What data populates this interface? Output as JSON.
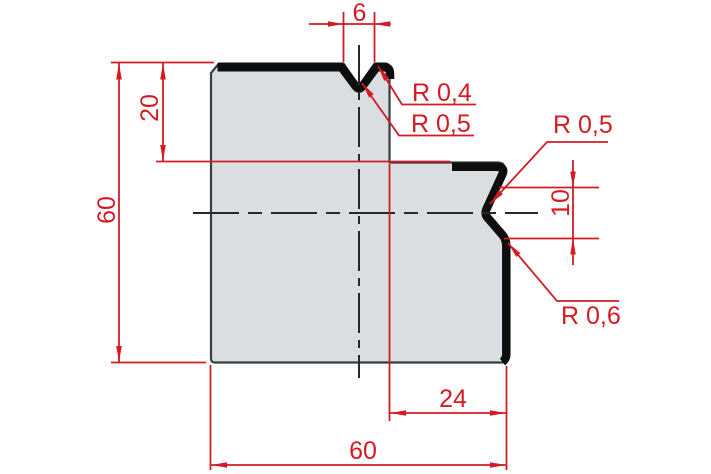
{
  "drawing": {
    "type": "technical-cross-section",
    "part_name": "press-brake-die-profile",
    "colors": {
      "dimension_red": "#d31b24",
      "part_fill": "#dbdee1",
      "outline_gray": "#3a3e42",
      "working_edge_black": "#0e0e0e",
      "centerline_dark": "#26282b",
      "background": "#ffffff"
    },
    "dimensions": {
      "top_notch_width": "6",
      "step_depth": "20",
      "overall_height": "60",
      "right_notch_height": "10",
      "step_width": "24",
      "overall_width": "60"
    },
    "radius_labels": {
      "top_notch_shoulder": "R 0,4",
      "top_notch_apex": "R 0,5",
      "right_notch_shoulder": "R 0,5",
      "right_notch_lower": "R 0,6"
    }
  }
}
